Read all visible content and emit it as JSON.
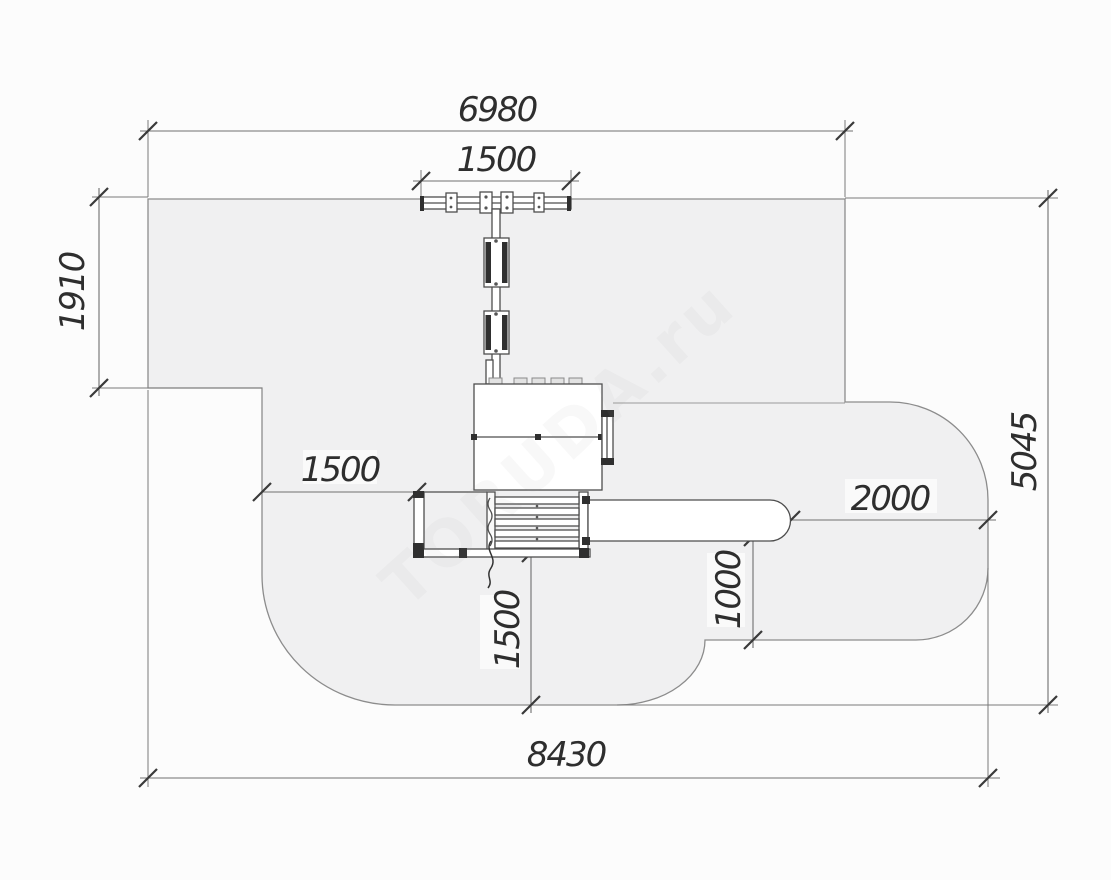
{
  "drawing": {
    "kind": "playground-equipment-safety-zone-plan",
    "watermark": {
      "text": "TORUDA.ru"
    }
  },
  "colors": {
    "background": "#fcfcfc",
    "zone_fill": "#f0f0f1",
    "zone_stroke": "#8c8c8c",
    "structure_line": "#4d4d4d",
    "dimension_line": "#6f6f6f",
    "dimension_text": "#2e2e2e",
    "watermark": "#9a9a9a"
  },
  "dimensions": {
    "top_width": {
      "value": "6980",
      "orientation": "horizontal",
      "role": "overall zone width at top"
    },
    "swing_beam_width": {
      "value": "1500",
      "orientation": "horizontal",
      "role": "swing beam length"
    },
    "left_height": {
      "value": "1910",
      "orientation": "vertical",
      "role": "upper-left zone depth"
    },
    "right_height": {
      "value": "5045",
      "orientation": "vertical",
      "role": "overall zone height right side"
    },
    "platform_clearance": {
      "value": "1500",
      "orientation": "horizontal",
      "role": "clearance left of platform"
    },
    "slide_runout": {
      "value": "2000",
      "orientation": "horizontal",
      "role": "clearance beyond slide end"
    },
    "slide_side_clearance": {
      "value": "1000",
      "orientation": "vertical",
      "role": "clearance below slide"
    },
    "bottom_clearance": {
      "value": "1500",
      "orientation": "vertical",
      "role": "clearance below stairs"
    },
    "total_width": {
      "value": "8430",
      "orientation": "horizontal",
      "role": "overall zone width at bottom"
    }
  }
}
